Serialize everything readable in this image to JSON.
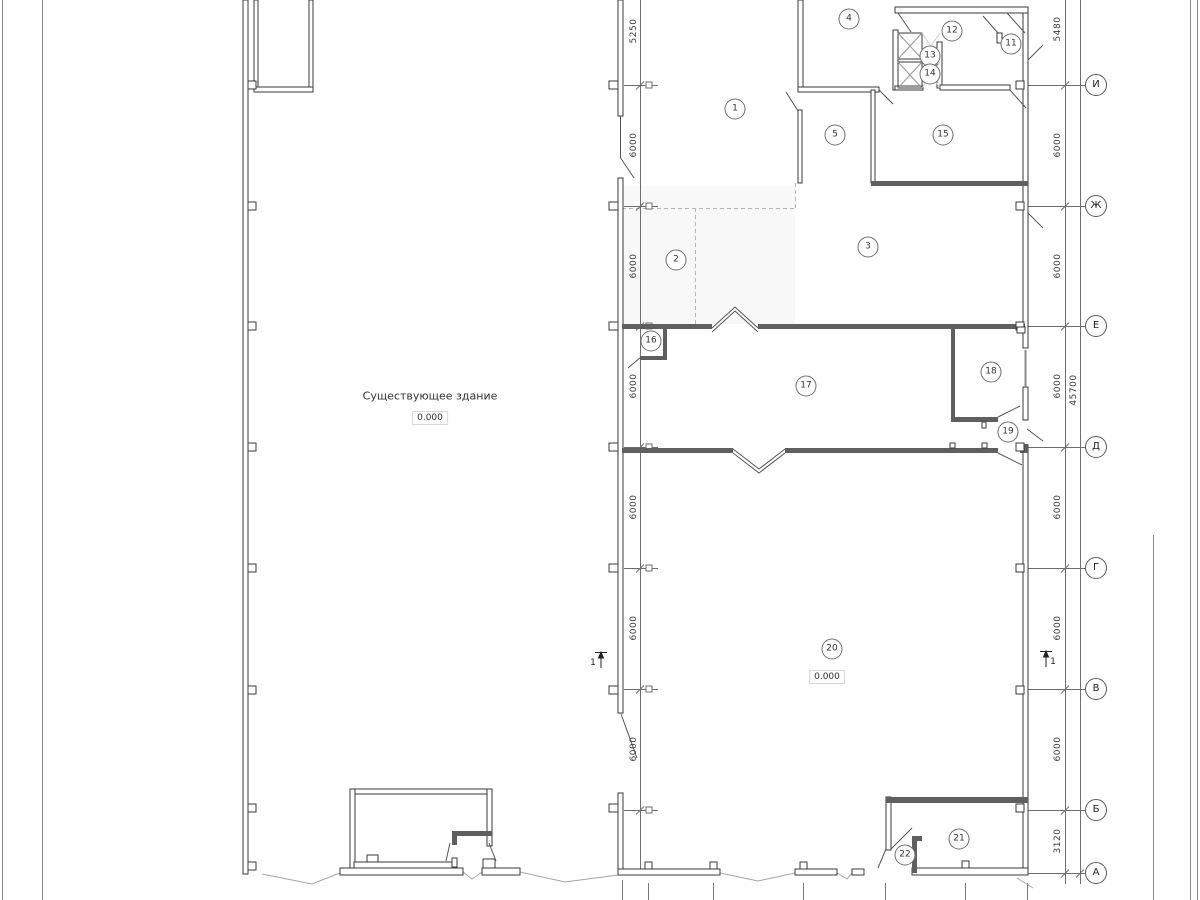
{
  "drawing": {
    "building_label": "Существующее здание",
    "building_elevation": "0.000",
    "room20_elevation": "0.000"
  },
  "rooms": [
    {
      "label": "1",
      "x": 735,
      "y": 109
    },
    {
      "label": "2",
      "x": 676,
      "y": 260
    },
    {
      "label": "3",
      "x": 868,
      "y": 247
    },
    {
      "label": "4",
      "x": 849,
      "y": 19
    },
    {
      "label": "5",
      "x": 835,
      "y": 135
    },
    {
      "label": "11",
      "x": 1011,
      "y": 44
    },
    {
      "label": "12",
      "x": 952,
      "y": 31
    },
    {
      "label": "13",
      "x": 930,
      "y": 56
    },
    {
      "label": "14",
      "x": 930,
      "y": 74
    },
    {
      "label": "15",
      "x": 943,
      "y": 135
    },
    {
      "label": "16",
      "x": 651,
      "y": 341
    },
    {
      "label": "17",
      "x": 806,
      "y": 386
    },
    {
      "label": "18",
      "x": 991,
      "y": 372
    },
    {
      "label": "19",
      "x": 1008,
      "y": 432
    },
    {
      "label": "20",
      "x": 832,
      "y": 649
    },
    {
      "label": "21",
      "x": 959,
      "y": 839
    },
    {
      "label": "22",
      "x": 905,
      "y": 855
    }
  ],
  "axes": [
    {
      "label": "И",
      "y": 85
    },
    {
      "label": "Ж",
      "y": 206
    },
    {
      "label": "Е",
      "y": 326
    },
    {
      "label": "Д",
      "y": 447
    },
    {
      "label": "Г",
      "y": 568
    },
    {
      "label": "В",
      "y": 689
    },
    {
      "label": "Б",
      "y": 810
    },
    {
      "label": "А",
      "y": 873
    }
  ],
  "dims_left": [
    {
      "label": "5250",
      "y": 31
    },
    {
      "label": "6000",
      "y": 145
    },
    {
      "label": "6000",
      "y": 266
    },
    {
      "label": "6000",
      "y": 386
    },
    {
      "label": "6000",
      "y": 507
    },
    {
      "label": "6000",
      "y": 628
    },
    {
      "label": "6000",
      "y": 749
    }
  ],
  "dims_right": [
    {
      "label": "5480",
      "y": 29
    },
    {
      "label": "6000",
      "y": 145
    },
    {
      "label": "6000",
      "y": 266
    },
    {
      "label": "6000",
      "y": 386
    },
    {
      "label": "6000",
      "y": 507
    },
    {
      "label": "6000",
      "y": 628
    },
    {
      "label": "6000",
      "y": 749
    },
    {
      "label": "3120",
      "y": 841
    }
  ],
  "dim_overall": {
    "label": "45700",
    "y": 390
  },
  "section_marks": {
    "left": "1",
    "right": "1"
  }
}
